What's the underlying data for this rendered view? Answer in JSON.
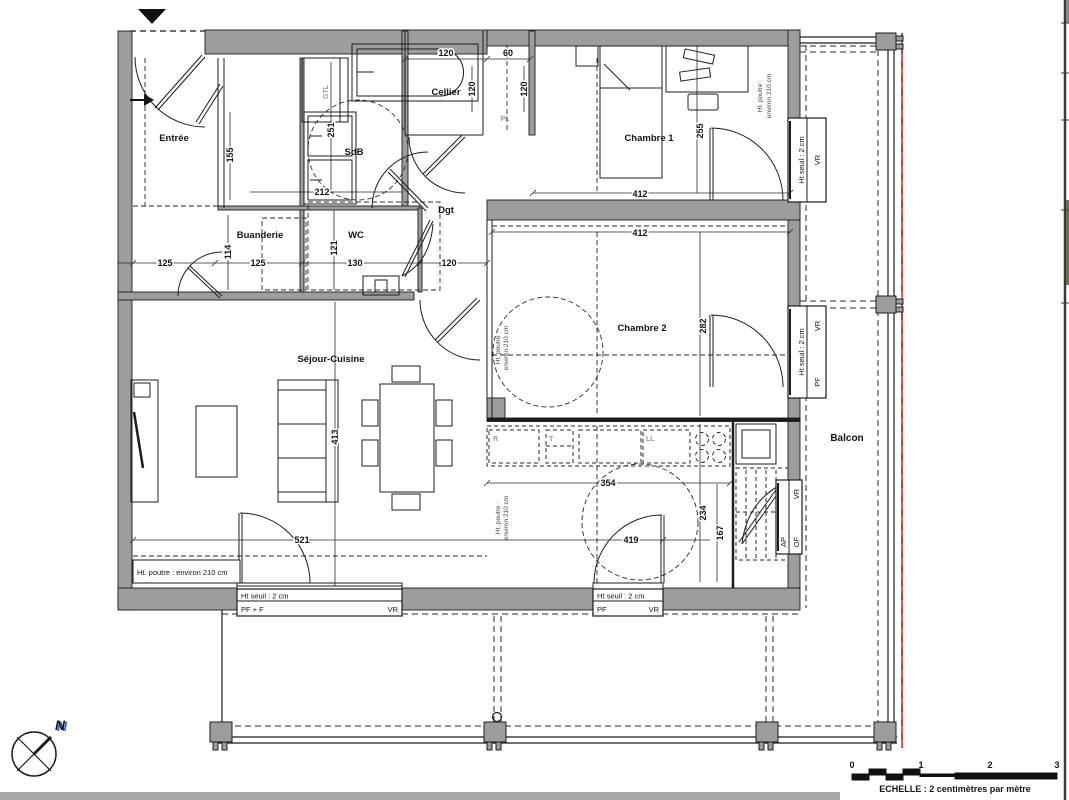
{
  "rooms": {
    "entree": "Entrée",
    "sdb": "SdB",
    "cellier": "Cellier",
    "chambre1": "Chambre 1",
    "buanderie": "Buanderie",
    "wc": "WC",
    "dgt": "Dgt",
    "chambre2": "Chambre 2",
    "sejour": "Séjour-Cuisine",
    "balcon": "Balcon"
  },
  "closets": {
    "gtl": "GTL",
    "pl": "PL"
  },
  "appliances": {
    "fridge": "R",
    "tall_unit": "T",
    "washer": "LL"
  },
  "dims": {
    "cellier_w": "120",
    "cellier_d": "120",
    "pl_w": "60",
    "pl_d": "120",
    "sdb_l": "251",
    "sdb_w": "212",
    "entree_closet": "155",
    "hall_a": "125",
    "hall_b": "125",
    "buanderie_d": "114",
    "wc_d": "121",
    "wc_w": "130",
    "dgt_w": "120",
    "ch1_w": "412",
    "ch1_d": "255",
    "ch2_w": "412",
    "ch2_d": "282",
    "sejour_l": "413",
    "sejour_w": "521",
    "kitchen_w": "354",
    "sejour_s": "419",
    "kitchen_d": "234",
    "hall2_d": "167"
  },
  "notes": {
    "beam": "Ht. poutre : environ 210 cm",
    "beam_l1": "Ht. poutre :",
    "beam_l2": "environ 210 cm",
    "sill": "Ht seuil : 2 cm",
    "pff": "PF + F",
    "pf": "PF",
    "vr": "VR",
    "ap": "AP",
    "of": "OF"
  },
  "compass": {
    "n": "N"
  },
  "scalebar": {
    "t0": "0",
    "t1": "1",
    "t2": "2",
    "t3": "3",
    "caption": "ECHELLE : 2 centimètres par mètre"
  },
  "colors": {
    "wall": "#9d9d9d",
    "line": "#1c1c1c",
    "red": "#e03131"
  }
}
